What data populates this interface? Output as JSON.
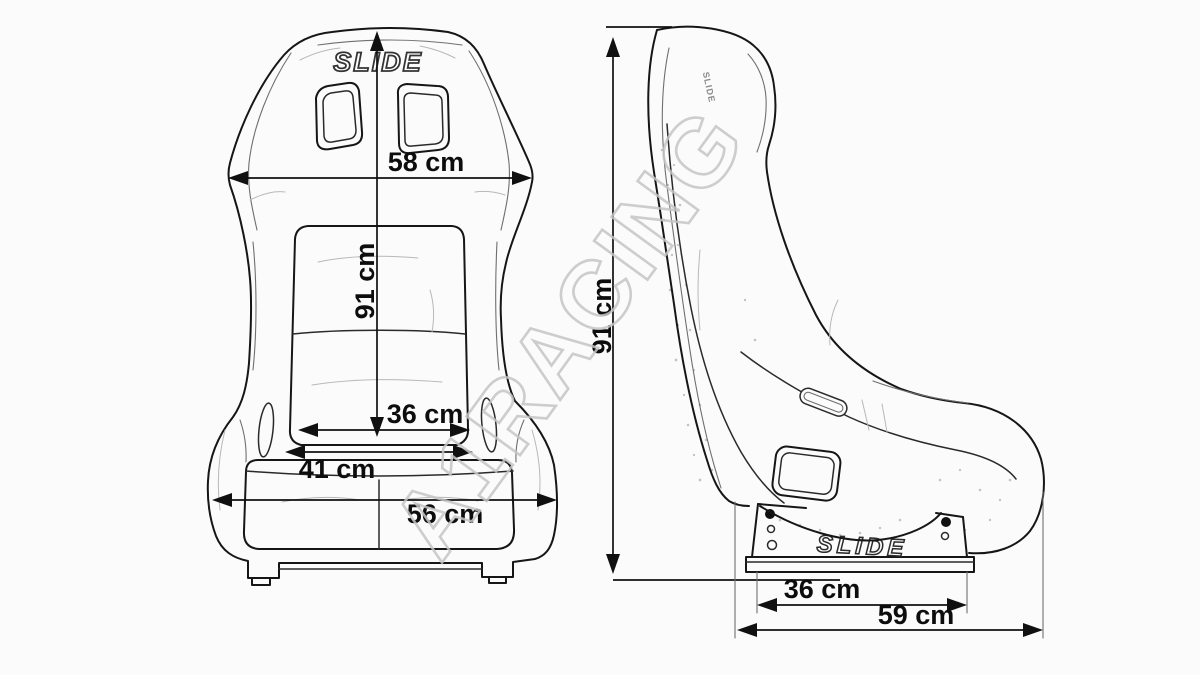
{
  "diagram": {
    "subject": "racing bucket seat technical dimension drawing, front and side view",
    "brand": "SLIDE",
    "watermark": "A1RACING",
    "colors": {
      "background": "#fbfbfb",
      "ink": "#161616",
      "watermark": "#c5c5c5"
    },
    "front_view": {
      "shoulder_width": "58 cm",
      "total_height": "91 cm",
      "seat_width_inner": "36 cm",
      "seat_width_mid": "41 cm",
      "seat_width_outer": "56 cm"
    },
    "side_view": {
      "total_height": "91 cm",
      "mount_length": "36 cm",
      "total_depth": "59 cm"
    }
  }
}
